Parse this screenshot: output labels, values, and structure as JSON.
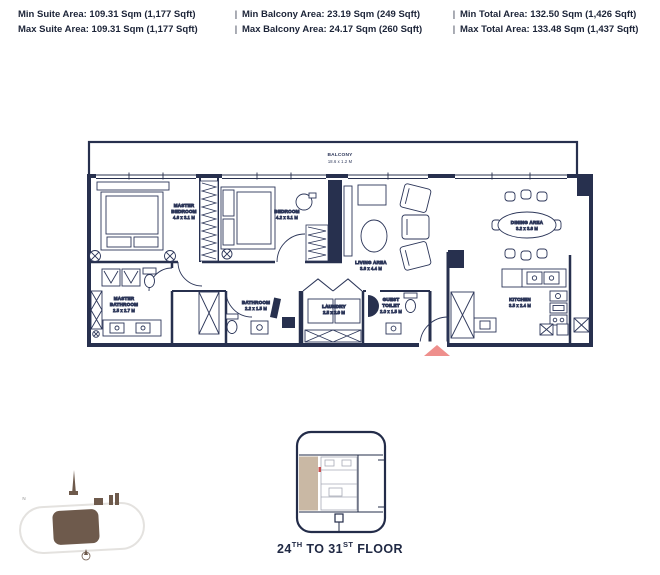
{
  "header": {
    "separator": "|",
    "rows": [
      {
        "suite": "Min Suite Area: 109.31 Sqm (1,177 Sqft)",
        "balcony": "Min Balcony Area: 23.19 Sqm (249 Sqft)",
        "total": "Min Total Area: 132.50 Sqm (1,426 Sqft)"
      },
      {
        "suite": "Max Suite Area: 109.31 Sqm (1,177 Sqft)",
        "balcony": "Max Balcony Area: 24.17 Sqm (260 Sqft)",
        "total": "Max Total Area: 133.48 Sqm (1,437 Sqft)"
      }
    ]
  },
  "plan": {
    "balcony": {
      "name": "BALCONY",
      "dim": "18.6 x 1.2 M"
    },
    "master_bedroom": {
      "l1": "MASTER",
      "l2": "BEDROOM",
      "dim": "4.6 x 3.1 M"
    },
    "bedroom": {
      "name": "BEDROOM",
      "dim": "4.2 x 3.1 M"
    },
    "living_area": {
      "name": "LIVING AREA",
      "dim": "3.6 x 4.4 M"
    },
    "dining_area": {
      "name": "DINING AREA",
      "dim": "3.2 x 3.6 M"
    },
    "kitchen": {
      "name": "KITCHEN",
      "dim": "3.5 x 2.4 M"
    },
    "master_bathroom": {
      "l1": "MASTER",
      "l2": "BATHROOM",
      "dim": "2.5 x 2.7 M"
    },
    "bathroom": {
      "name": "BATHROOM",
      "dim": "2.2 x 1.5 M"
    },
    "laundry": {
      "name": "LAUNDRY",
      "dim": "2.5 x 2.0 M"
    },
    "guest_toilet": {
      "l1": "GUEST",
      "l2": "TOILET",
      "dim": "2.0 x 1.5 M"
    }
  },
  "keyplan": {
    "floor_num1": "24",
    "floor_sup1": "TH",
    "floor_mid": " TO 31",
    "floor_sup2": "ST",
    "floor_rest": " FLOOR"
  },
  "locator": {
    "north_label": "N"
  },
  "colors": {
    "wall": "#27304e",
    "entry_marker": "#ee8f8c",
    "keyplan_highlight": "#c9b8a4",
    "locator_brown": "#6e5a4c"
  }
}
